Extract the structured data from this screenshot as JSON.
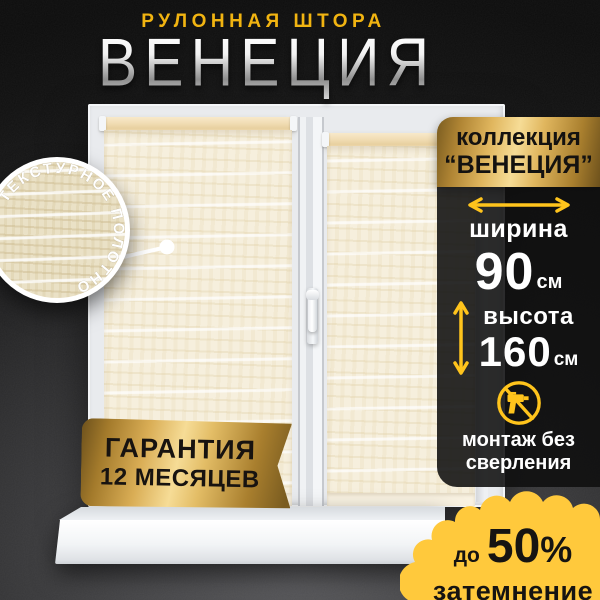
{
  "header": {
    "kicker": "РУЛОННАЯ ШТОРА",
    "title": "ВЕНЕЦИЯ"
  },
  "swatch": {
    "curved_label": "ТЕКСТУРНОЕ ПОЛОТНО"
  },
  "warranty": {
    "line1": "ГАРАНТИЯ",
    "line2": "12 МЕСЯЦЕВ"
  },
  "info_panel": {
    "collection_line1": "коллекция",
    "collection_line2": "“ВЕНЕЦИЯ”",
    "width": {
      "label": "ширина",
      "value": "90",
      "unit": "см"
    },
    "height": {
      "label": "высота",
      "value": "160",
      "unit": "см"
    },
    "mount": {
      "line1": "монтаж без",
      "line2": "сверления",
      "icon": "no-drill-icon"
    }
  },
  "dimout": {
    "prefix": "до",
    "value": "50",
    "percent": "%",
    "label": "затемнение"
  },
  "colors": {
    "background_dark": "#1a1a1b",
    "accent_yellow": "#ffc41c",
    "blob_yellow": "#ffc93c",
    "gold_light": "#f6dc96",
    "gold_dark": "#7a5c20",
    "kicker_gold": "#f1b411",
    "fabric_cream": "#f6efdd",
    "panel_black": "#0f0f0f",
    "text_white": "#ffffff",
    "text_black": "#161412"
  }
}
